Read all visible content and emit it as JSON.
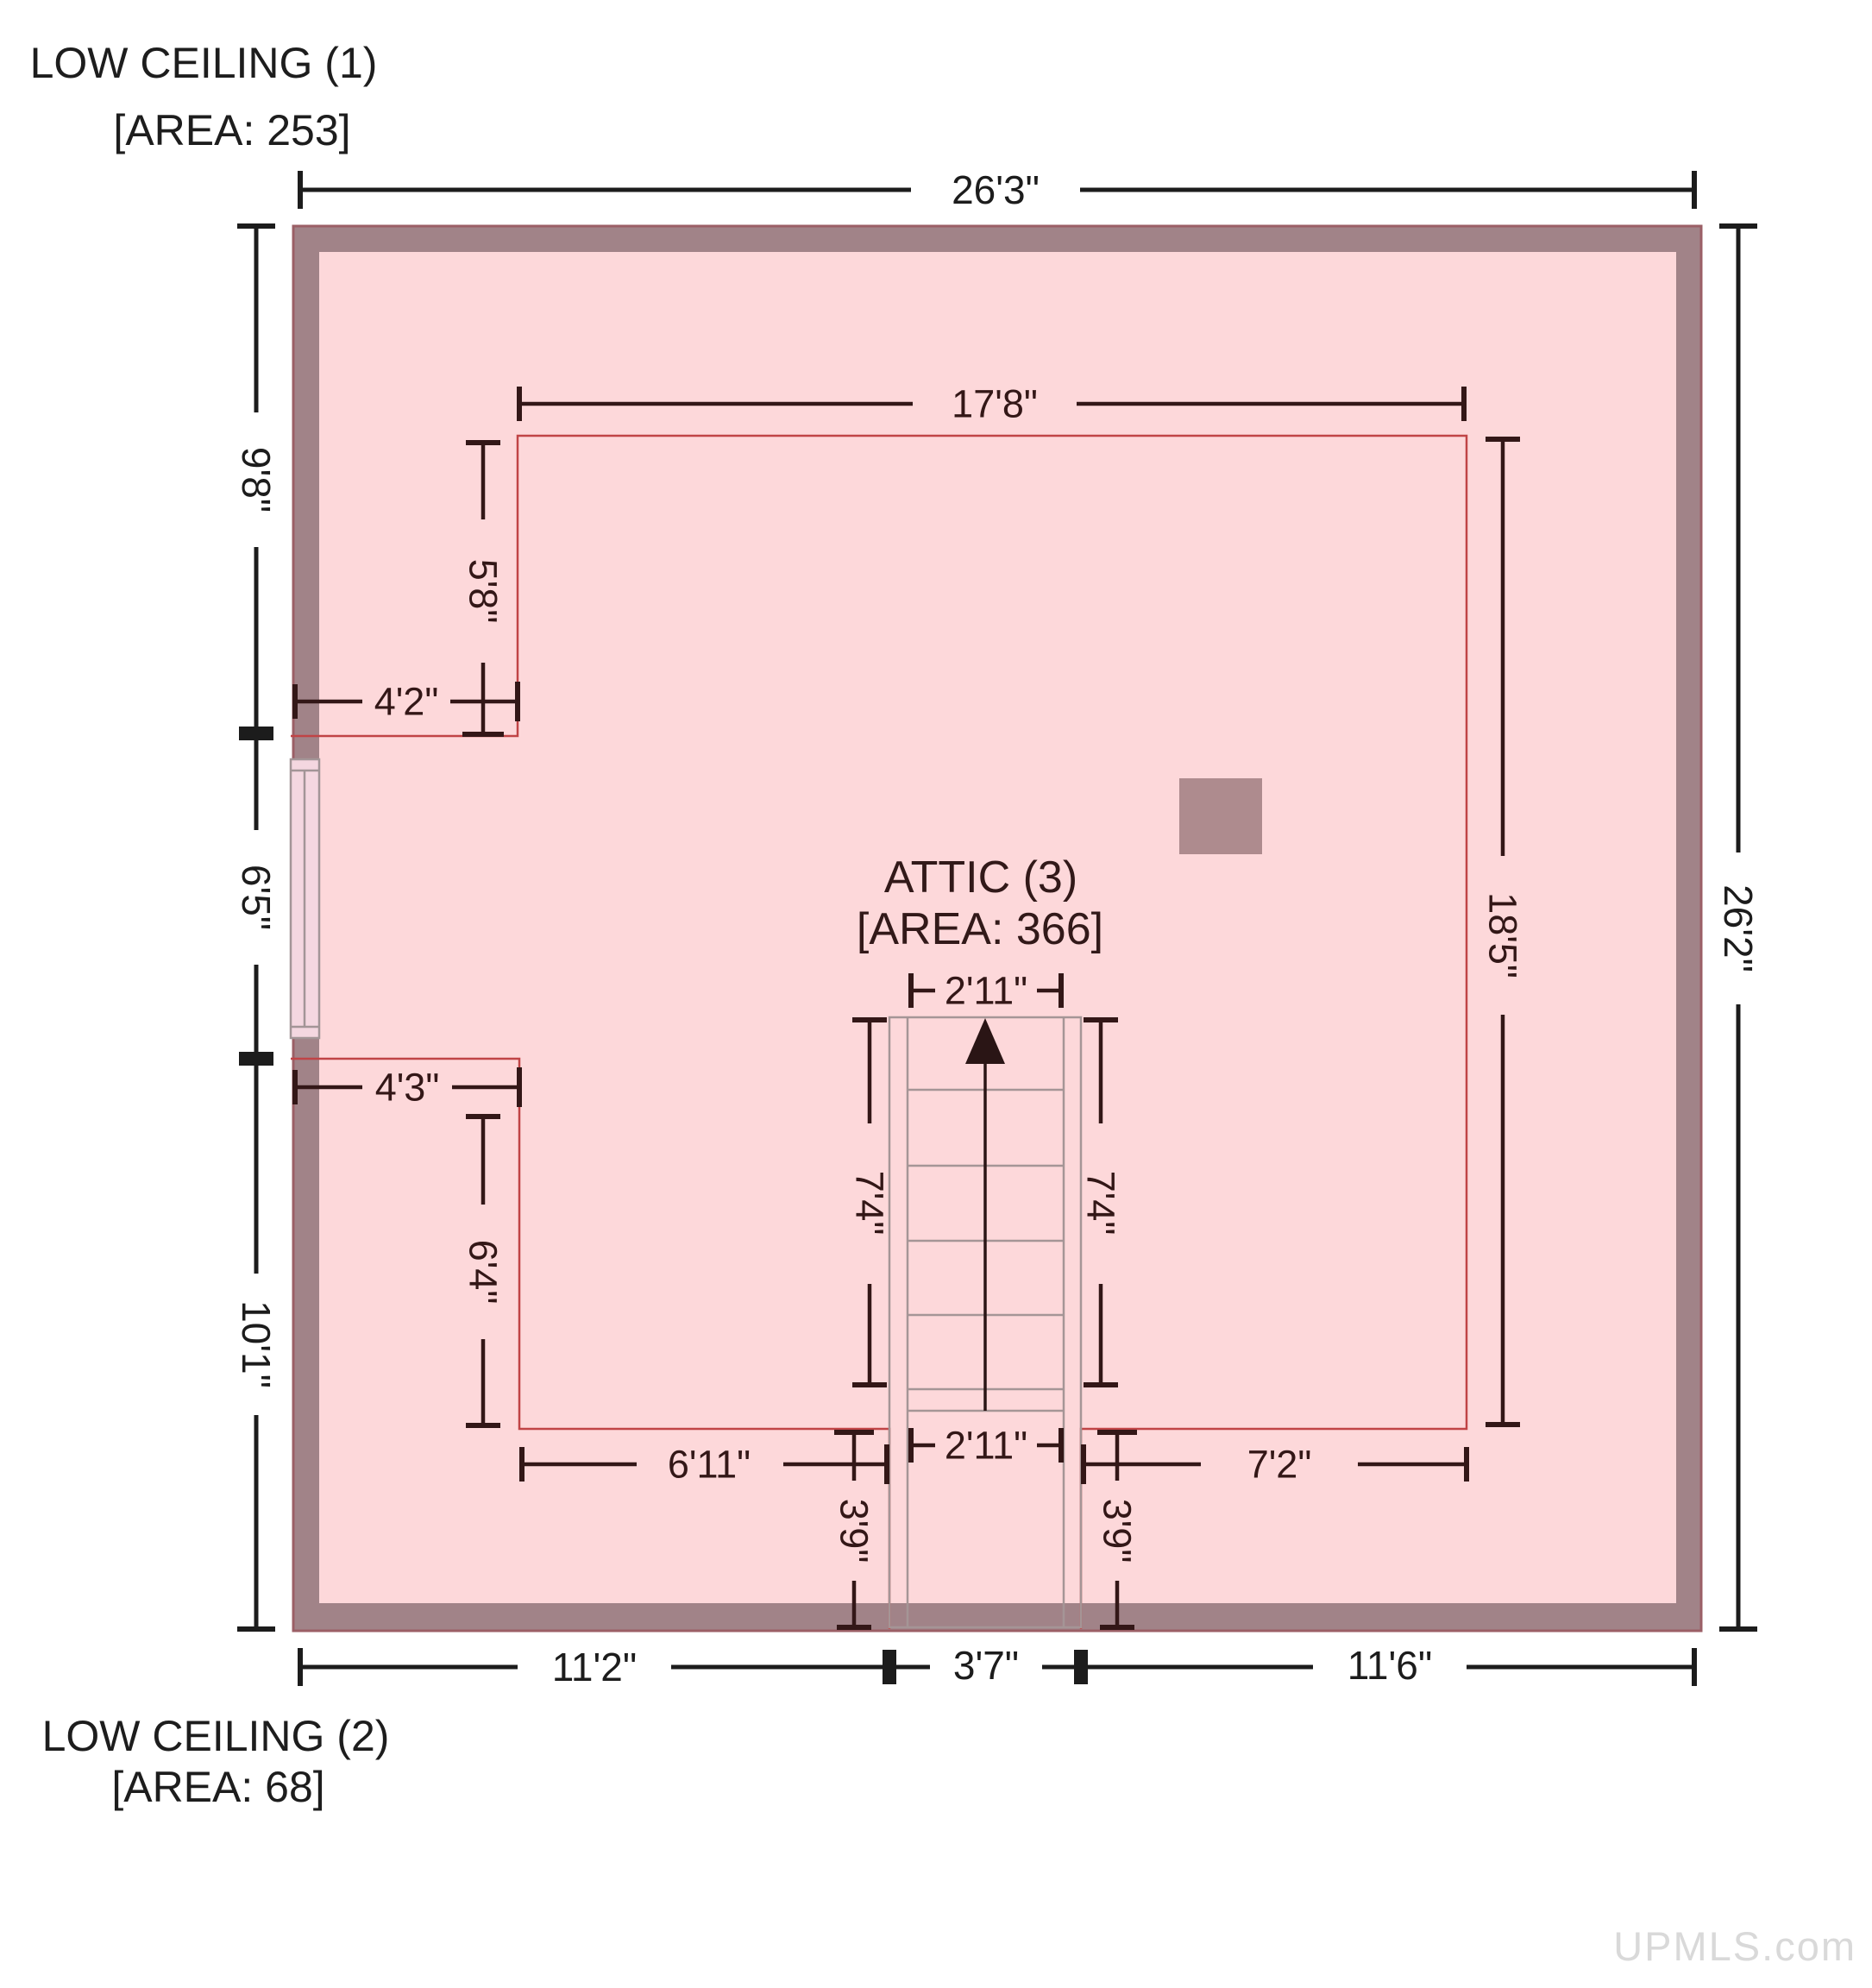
{
  "labels": {
    "low_ceiling_1_name": "LOW CEILING (1)",
    "low_ceiling_1_area": "[AREA: 253]",
    "low_ceiling_2_name": "LOW CEILING (2)",
    "low_ceiling_2_area": "[AREA: 68]",
    "room_name": "ATTIC (3)",
    "room_area": "[AREA: 366]",
    "watermark": "UPMLS.com"
  },
  "dims": {
    "top_width": "26'3\"",
    "right_height": "26'2\"",
    "left_top": "9'8\"",
    "left_mid": "6'5\"",
    "left_bottom": "10'1\"",
    "bottom_left": "11'2\"",
    "bottom_center": "3'7\"",
    "bottom_right": "11'6\"",
    "attic_width": "17'8\"",
    "attic_height": "18'5\"",
    "notch_top_height": "5'8\"",
    "notch_top_width": "4'2\"",
    "notch_bottom_width": "4'3\"",
    "notch_bottom_height": "6'4\"",
    "low2_left_width": "6'11\"",
    "low2_right_width": "7'2\"",
    "stair_width_top": "2'11\"",
    "stair_width_bottom": "2'11\"",
    "stair_height_left": "7'4\"",
    "stair_height_right": "7'4\"",
    "low2_left_height": "3'9\"",
    "low2_right_height": "3'9\""
  },
  "colors": {
    "wall": "#a18388",
    "wall_border": "#9b5f66",
    "floor": "#fdd8da",
    "window_fill": "#f4d7e0",
    "window_frame": "#a39597",
    "chimney": "#ae8b8e",
    "boundary": "#c04446",
    "stair": "#a59596",
    "dim_inner": "#331717",
    "dim_outer": "#1c1c1c",
    "label_text": "#1d1d1d",
    "room_text": "#321919",
    "watermark": "#d9d9d9",
    "arrow": "#2a1515"
  }
}
